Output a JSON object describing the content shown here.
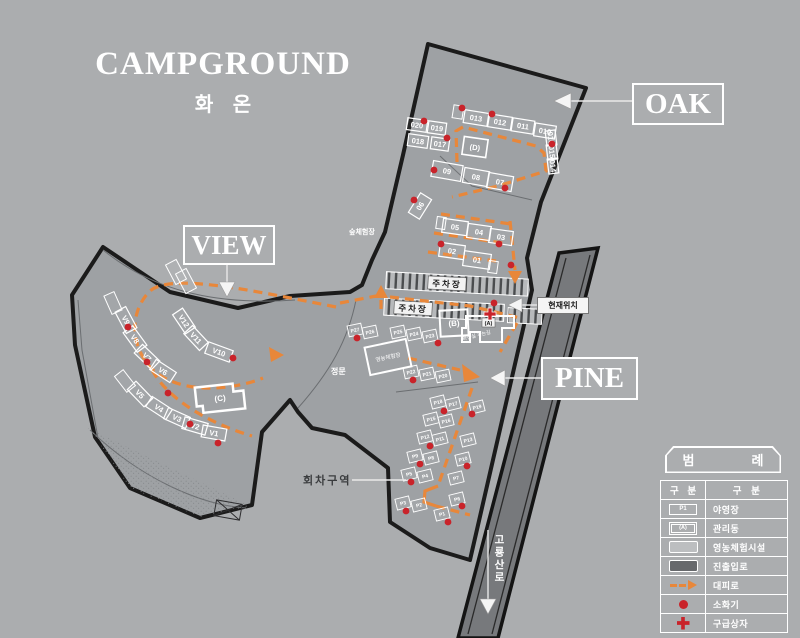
{
  "title": {
    "main": "CAMPGROUND",
    "subtitle": "화 온"
  },
  "area_labels": {
    "oak": "OAK",
    "view": "VIEW",
    "pine": "PINE"
  },
  "map_labels": {
    "current_location": "현재위치",
    "turn_area": "회차구역",
    "road_name": "고룡산로",
    "parking1": "주차장",
    "parking2": "주차장",
    "main_gate": "정문",
    "forest_exp": "숲체험장",
    "farm_exp": "영농체험장",
    "path_note": "화장실 가는길"
  },
  "buildings": [
    {
      "id": "A",
      "label": "(A)"
    },
    {
      "id": "B",
      "label": "(B)"
    },
    {
      "id": "C",
      "label": "(C)"
    },
    {
      "id": "D",
      "label": "(D)"
    }
  ],
  "legend": {
    "title_left": "범",
    "title_right": "례",
    "col_headers": [
      "구 분",
      "구 분"
    ],
    "rows": [
      [
        "P1",
        "야영장"
      ],
      [
        "(A)",
        "관리동"
      ],
      [
        "",
        "영농체험시설"
      ],
      [
        "",
        "진출입로"
      ],
      [
        "",
        "대피로"
      ],
      [
        "",
        "소화기"
      ],
      [
        "",
        "구급상자"
      ]
    ]
  },
  "sites": {
    "oak": [
      {
        "label": "020",
        "cx": 417,
        "cy": 125,
        "w": 20,
        "h": 12
      },
      {
        "label": "019",
        "cx": 437,
        "cy": 128,
        "w": 18,
        "h": 12
      },
      {
        "label": "018",
        "cx": 418,
        "cy": 141,
        "w": 20,
        "h": 12
      },
      {
        "label": "017",
        "cx": 440,
        "cy": 144,
        "w": 18,
        "h": 12
      },
      {
        "label": "013",
        "cx": 476,
        "cy": 118,
        "w": 24,
        "h": 13,
        "rot": 9
      },
      {
        "label": "012",
        "cx": 500,
        "cy": 122,
        "w": 23,
        "h": 13,
        "rot": 9
      },
      {
        "label": "011",
        "cx": 523,
        "cy": 126,
        "w": 22,
        "h": 13,
        "rot": 9
      },
      {
        "label": "010",
        "cx": 545,
        "cy": 131,
        "w": 21,
        "h": 13,
        "rot": 9
      },
      {
        "label": "016",
        "cx": 551,
        "cy": 138,
        "w": 15,
        "h": 10,
        "rot": 83
      },
      {
        "label": "015",
        "cx": 552,
        "cy": 152,
        "w": 15,
        "h": 10,
        "rot": 83
      },
      {
        "label": "014",
        "cx": 553,
        "cy": 166,
        "w": 15,
        "h": 10,
        "rot": 83
      },
      {
        "label": "09",
        "cx": 447,
        "cy": 171,
        "w": 30,
        "h": 16,
        "rot": 10
      },
      {
        "label": "08",
        "cx": 476,
        "cy": 177,
        "w": 25,
        "h": 15,
        "rot": 10
      },
      {
        "label": "07",
        "cx": 500,
        "cy": 182,
        "w": 25,
        "h": 15,
        "rot": 10
      },
      {
        "label": "06",
        "cx": 420,
        "cy": 206,
        "w": 23,
        "h": 13,
        "rot": -58
      },
      {
        "label": "05",
        "cx": 455,
        "cy": 227,
        "w": 25,
        "h": 14
      },
      {
        "label": "04",
        "cx": 479,
        "cy": 232,
        "w": 23,
        "h": 14
      },
      {
        "label": "03",
        "cx": 501,
        "cy": 237,
        "w": 23,
        "h": 14
      },
      {
        "label": "02",
        "cx": 452,
        "cy": 251,
        "w": 25,
        "h": 14
      },
      {
        "label": "01",
        "cx": 477,
        "cy": 260,
        "w": 27,
        "h": 15
      }
    ],
    "view": [
      {
        "label": "V9",
        "cx": 126,
        "cy": 320,
        "rot": 62
      },
      {
        "label": "V8",
        "cx": 135,
        "cy": 339,
        "rot": 54
      },
      {
        "label": "V7",
        "cx": 147,
        "cy": 357,
        "rot": 44
      },
      {
        "label": "V6",
        "cx": 163,
        "cy": 371,
        "rot": 33
      },
      {
        "label": "V12",
        "cx": 184,
        "cy": 321,
        "w": 23,
        "rot": 56
      },
      {
        "label": "V11",
        "cx": 196,
        "cy": 338,
        "w": 23,
        "rot": 47
      },
      {
        "label": "V10",
        "cx": 219,
        "cy": 352,
        "w": 26,
        "rot": 20
      },
      {
        "label": "V5",
        "cx": 140,
        "cy": 394,
        "rot": 46
      },
      {
        "label": "V4",
        "cx": 159,
        "cy": 408,
        "rot": 33
      },
      {
        "label": "V3",
        "cx": 177,
        "cy": 418,
        "rot": 24
      },
      {
        "label": "V2",
        "cx": 195,
        "cy": 426,
        "rot": 16
      },
      {
        "label": "V1",
        "cx": 214,
        "cy": 433,
        "rot": 10
      }
    ],
    "pine": [
      {
        "label": "P18",
        "cx": 438,
        "cy": 402
      },
      {
        "label": "P17",
        "cx": 453,
        "cy": 404
      },
      {
        "label": "P19",
        "cx": 477,
        "cy": 407
      },
      {
        "label": "P15",
        "cx": 431,
        "cy": 419
      },
      {
        "label": "P16",
        "cx": 446,
        "cy": 421
      },
      {
        "label": "P12",
        "cx": 425,
        "cy": 437
      },
      {
        "label": "P11",
        "cx": 440,
        "cy": 439
      },
      {
        "label": "P13",
        "cx": 468,
        "cy": 440
      },
      {
        "label": "P9",
        "cx": 415,
        "cy": 456
      },
      {
        "label": "P8",
        "cx": 431,
        "cy": 458
      },
      {
        "label": "P10",
        "cx": 463,
        "cy": 459
      },
      {
        "label": "P5",
        "cx": 409,
        "cy": 474
      },
      {
        "label": "P4",
        "cx": 425,
        "cy": 476
      },
      {
        "label": "P7",
        "cx": 456,
        "cy": 478
      },
      {
        "label": "P3",
        "cx": 403,
        "cy": 503
      },
      {
        "label": "P2",
        "cx": 419,
        "cy": 505
      },
      {
        "label": "P6",
        "cx": 457,
        "cy": 499
      },
      {
        "label": "P1",
        "cx": 442,
        "cy": 514
      }
    ],
    "mid": [
      {
        "label": "P27",
        "cx": 355,
        "cy": 330
      },
      {
        "label": "P26",
        "cx": 370,
        "cy": 332
      },
      {
        "label": "P25",
        "cx": 398,
        "cy": 332
      },
      {
        "label": "P24",
        "cx": 414,
        "cy": 334
      },
      {
        "label": "P23",
        "cx": 430,
        "cy": 336
      },
      {
        "label": "P22",
        "cx": 411,
        "cy": 372
      },
      {
        "label": "P21",
        "cx": 427,
        "cy": 374
      },
      {
        "label": "P20",
        "cx": 443,
        "cy": 376
      }
    ],
    "extras": [
      {
        "cx": 458,
        "cy": 112,
        "w": 10,
        "h": 13,
        "rot": 9
      },
      {
        "cx": 441,
        "cy": 223,
        "w": 9,
        "h": 12,
        "rot": 8
      },
      {
        "cx": 493,
        "cy": 267,
        "w": 9,
        "h": 12,
        "rot": 8
      },
      {
        "cx": 113,
        "cy": 303,
        "w": 20,
        "h": 11,
        "rot": 66
      },
      {
        "cx": 125,
        "cy": 381,
        "w": 20,
        "h": 11,
        "rot": 52
      },
      {
        "cx": 176,
        "cy": 272,
        "w": 22,
        "h": 12,
        "rot": 62
      },
      {
        "cx": 186,
        "cy": 281,
        "w": 22,
        "h": 12,
        "rot": 62
      }
    ]
  },
  "fire_extinguishers": [
    [
      462,
      108
    ],
    [
      492,
      114
    ],
    [
      424,
      121
    ],
    [
      447,
      138
    ],
    [
      434,
      170
    ],
    [
      505,
      188
    ],
    [
      414,
      200
    ],
    [
      441,
      244
    ],
    [
      499,
      244
    ],
    [
      511,
      265
    ],
    [
      552,
      144
    ],
    [
      357,
      338
    ],
    [
      438,
      343
    ],
    [
      413,
      380
    ],
    [
      494,
      303
    ],
    [
      128,
      327
    ],
    [
      147,
      362
    ],
    [
      168,
      393
    ],
    [
      190,
      424
    ],
    [
      218,
      443
    ],
    [
      233,
      358
    ],
    [
      444,
      411
    ],
    [
      472,
      414
    ],
    [
      430,
      446
    ],
    [
      420,
      464
    ],
    [
      467,
      466
    ],
    [
      411,
      482
    ],
    [
      406,
      511
    ],
    [
      448,
      522
    ],
    [
      462,
      506
    ]
  ],
  "first_aid": [
    [
      490,
      314
    ]
  ],
  "colors": {
    "background": "#abadaf",
    "map_fill": "#9ea1a4",
    "road_fill": "#77797c",
    "route_orange": "#e8873a",
    "marker_red": "#c9232a",
    "outline_black": "#1b1b1b"
  }
}
